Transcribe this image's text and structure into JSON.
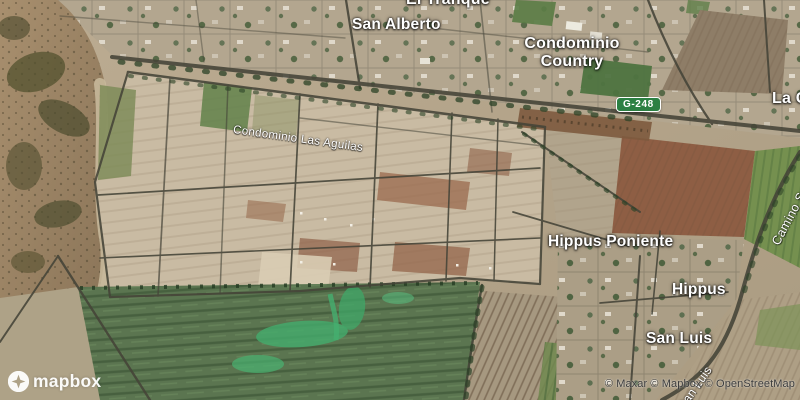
{
  "map": {
    "place_labels": {
      "el_tranque": "El Tranque",
      "san_alberto": "San Alberto",
      "condominio_country": "Condominio Country",
      "la_c": "La C",
      "hippus_poniente": "Hippus Poniente",
      "hippus": "Hippus",
      "san_luis": "San Luis"
    },
    "road_labels": {
      "condominio_las_aguilas": "Condominio Las Aguilas",
      "camino": "Camino S",
      "san_luis_road": "San Luis"
    },
    "route_shield": {
      "text": "G-248",
      "color": "#2c8043"
    },
    "logo_text": "mapbox",
    "attribution": "© Maxar © Mapbox © OpenStreetMap",
    "label_color": "#ffffff",
    "attribution_color": "#3b3b3b"
  }
}
